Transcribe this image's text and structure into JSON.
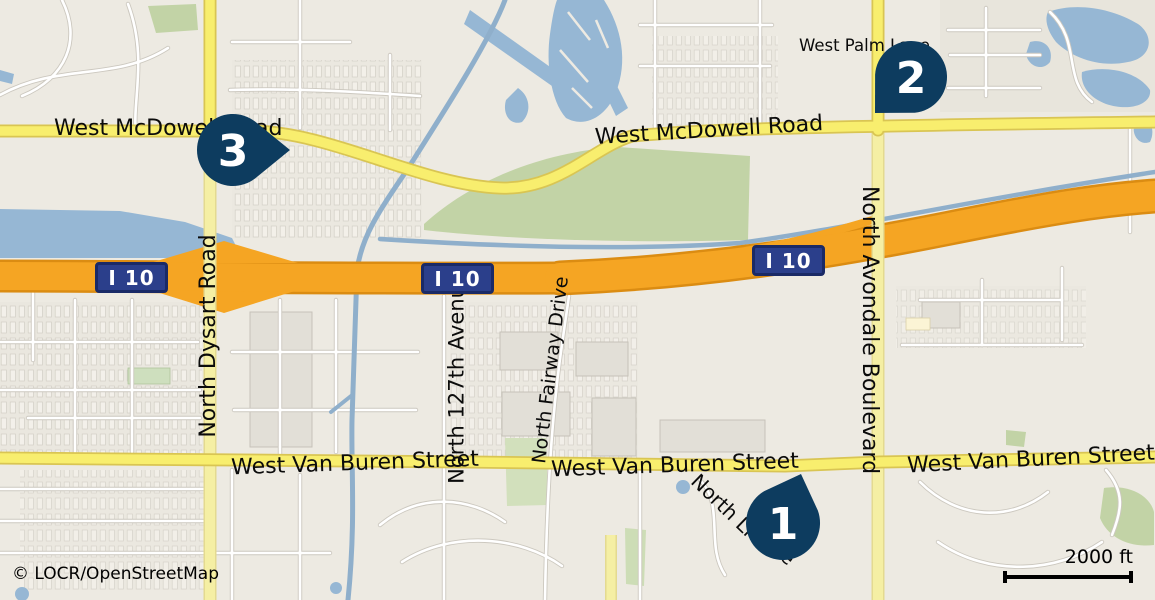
{
  "map": {
    "attribution": "© LOCR/OpenStreetMap",
    "scale_bar": {
      "label": "2000 ft"
    },
    "markers": [
      {
        "number": "1"
      },
      {
        "number": "2"
      },
      {
        "number": "3"
      }
    ],
    "shields": [
      {
        "label": "I 10"
      },
      {
        "label": "I 10"
      },
      {
        "label": "I 10"
      }
    ],
    "road_labels": [
      {
        "name": "west-mcdowell-road-left",
        "text": "West McDowell Road"
      },
      {
        "name": "west-mcdowell-road-right",
        "text": "West McDowell Road"
      },
      {
        "name": "west-palm-lane",
        "text": "West Palm Lane"
      },
      {
        "name": "north-dysart-road",
        "text": "North Dysart Road"
      },
      {
        "name": "north-127th-avenue",
        "text": "North 127th Avenue"
      },
      {
        "name": "north-fairway-drive",
        "text": "North Fairway Drive"
      },
      {
        "name": "north-avondale-boulevard",
        "text": "North Avondale Boulevard"
      },
      {
        "name": "west-van-buren-street-left",
        "text": "West Van Buren Street"
      },
      {
        "name": "west-van-buren-street-center",
        "text": "West Van Buren Street"
      },
      {
        "name": "west-van-buren-street-right",
        "text": "West Van Buren Street"
      },
      {
        "name": "north-li-partial",
        "text": "North Li"
      },
      {
        "name": "north-li-partial-tail",
        "text": "e"
      }
    ],
    "colors": {
      "marker": "#0d3c5f",
      "shield_background": "#2b3f8b",
      "shield_border": "#1a2a66",
      "motorway": "#f5a523",
      "primary_road": "#f8ee6e",
      "secondary_road": "#f5efa4",
      "water": "#96b7d4",
      "green_area": "#c2d3a6",
      "land": "#edeae2"
    }
  }
}
